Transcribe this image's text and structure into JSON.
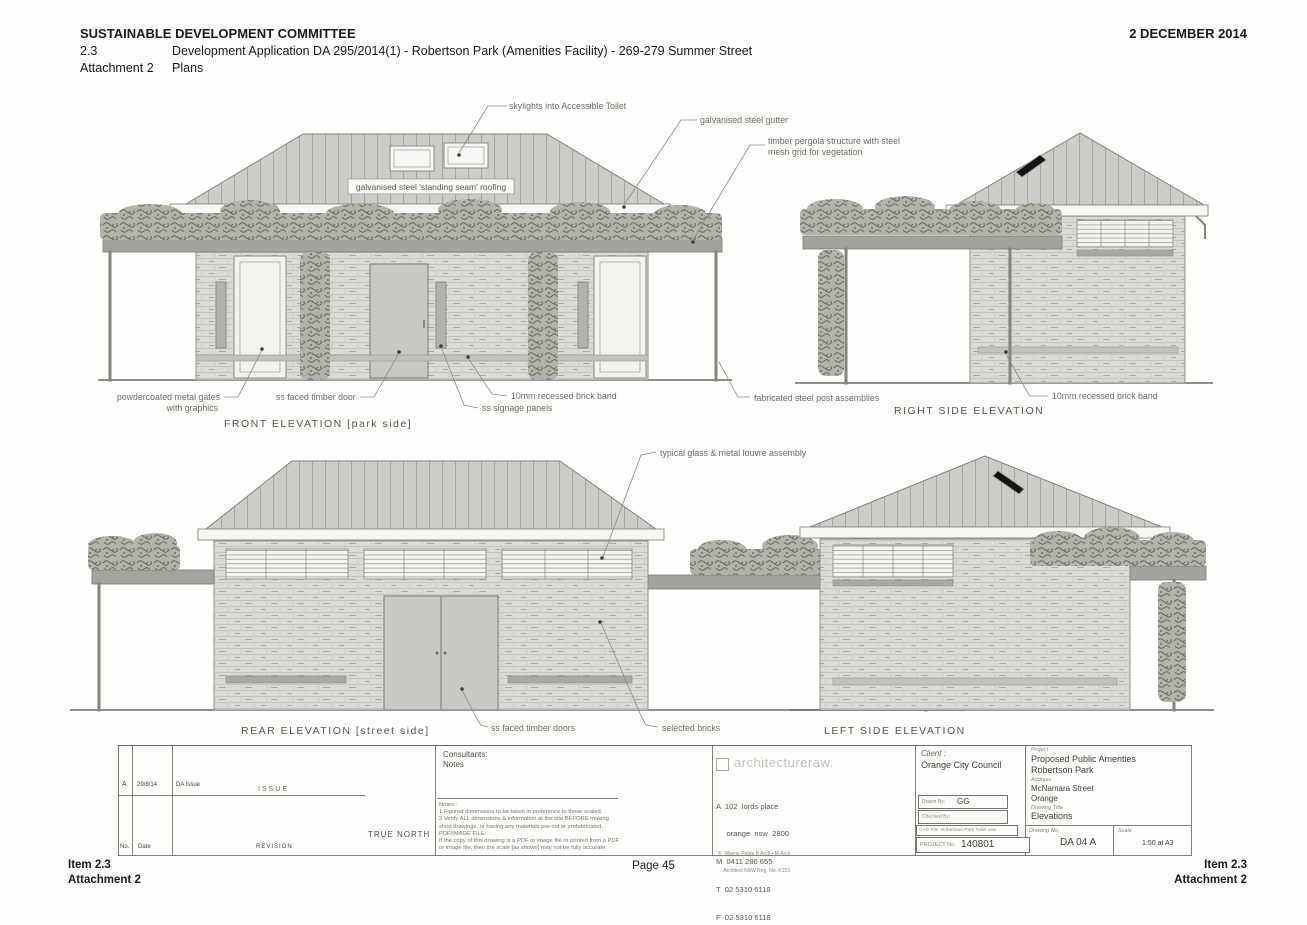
{
  "header": {
    "committee": "SUSTAINABLE DEVELOPMENT COMMITTEE",
    "date": "2 DECEMBER 2014",
    "item_number": "2.3",
    "item_title": "Development Application DA 295/2014(1) - Robertson Park (Amenities Facility) - 269-279 Summer Street",
    "attachment_label": "Attachment 2",
    "attachment_title": "Plans"
  },
  "annotations": {
    "skylights": "skylights into Accessible Toilet",
    "gutter": "galvanised steel gutter",
    "pergola1": "timber pergola structure with steel",
    "pergola2": "mesh grid for vegetation",
    "roofing": "galvanised steel 'standing seam' roofing",
    "gates1": "powdercoated metal gates",
    "gates2": "with graphics",
    "timber_door": "ss faced timber door",
    "brick_band_front": "10mm recessed brick band",
    "signage": "ss signage panels",
    "posts": "fabricated steel post assemblies",
    "brick_band_right": "10mm recessed brick band",
    "louvre": "typical glass & metal louvre assembly",
    "timber_doors": "ss faced timber doors",
    "selected_bricks": "selected bricks"
  },
  "elevations": {
    "front": "FRONT  ELEVATION [park side]",
    "right": "RIGHT SIDE  ELEVATION",
    "rear": "REAR  ELEVATION [street side]",
    "left": "LEFT SIDE  ELEVATION"
  },
  "title_block": {
    "issue_table": {
      "row_rev": "A",
      "row_date": "29/8/14",
      "row_desc": "DA Issue",
      "issue_label": "ISSUE",
      "col_no": "No.",
      "col_date": "Date",
      "col_revision": "REVISION",
      "true_north": "TRUE NORTH"
    },
    "consultants": {
      "label": "Consultants:",
      "notes_label": "Notes",
      "notes": [
        "Notes :",
        "1  Figured dimensions to be taken in preference to those scaled.",
        "2  Verify ALL dimensions & information at the site BEFORE making",
        "    shop drawings, or having any materials pre-cut or prefabricated.",
        "PDF/IMAGE FILE:",
        "If the copy of this drawing is a PDF or image file or printed from a PDF",
        "or image file, then the scale [as shown] may not be fully accurate."
      ]
    },
    "architect": {
      "logo": "architectureraw.",
      "address1": "A  102  lords place",
      "address2": "     orange  nsw  2800",
      "mobile": "M  0411 286 655",
      "tel": "T  02 5310 6118",
      "fax": "F  02 5310 6118",
      "email": "E  wayne@architectureraw.com.au",
      "registration1": "©  Wayne Petrie B Arch • M Arch",
      "registration2": "    Architect NSW Reg. No. K159"
    },
    "client": {
      "label": "Client :",
      "name": "Orange City Council",
      "drawn_by_label": "Drawn By:",
      "drawn_by": "GG",
      "checked_by_label": "Checked By:",
      "cad_file": "CAD File: Robertson Park Toilet.vwx",
      "project_no_label": "PROJECT No.",
      "project_no": "140801"
    },
    "project": {
      "label": "Project",
      "name1": "Proposed Public Amenties",
      "name2": "Robertson Park",
      "address_label": "Address",
      "address1": "McNamara Street",
      "address2": "Orange",
      "drawing_title_label": "Drawing Title",
      "drawing_title": "Elevations",
      "drawing_no_label": "Drawing No.",
      "drawing_no": "DA 04 A",
      "scale_label": "Scale",
      "scale": "1:50 at A3"
    }
  },
  "footer": {
    "item": "Item 2.3",
    "attachment": "Attachment 2",
    "page": "Page 45"
  }
}
